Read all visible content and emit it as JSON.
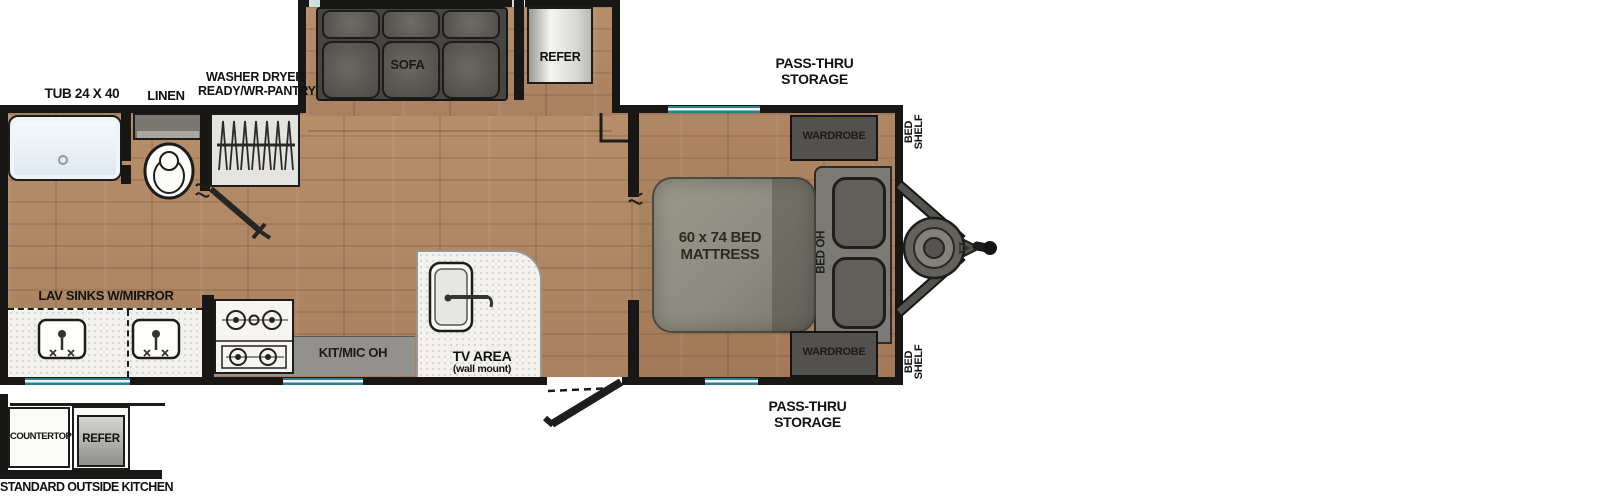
{
  "colors": {
    "floor_wood": "#b08a65",
    "wall_black": "#181715",
    "window_teal": "#2f7e8d",
    "counter_white": "#f2f1ed",
    "cushion_gray": "#5b5954",
    "mattress_gray": "#8e8b83",
    "label_black": "#121210"
  },
  "floorplan": {
    "bathroom": {
      "tub": "TUB 24 X 40",
      "linen": "LINEN",
      "pantry_line1": "WASHER DRYER",
      "pantry_line2": "READY/WR-PANTRY",
      "lav": "LAV SINKS W/MIRROR"
    },
    "living": {
      "sofa": "SOFA",
      "refer": "REFER",
      "kit_overhead": "KIT/MIC OH",
      "tv_line1": "TV AREA",
      "tv_line2": "(wall mount)"
    },
    "bedroom": {
      "mattress_line1": "60 x 74 BED",
      "mattress_line2": "MATTRESS",
      "bed_oh": "BED OH",
      "wardrobe": "WARDROBE",
      "bed_shelf_line1": "BED",
      "bed_shelf_line2": "SHELF"
    },
    "storage": {
      "pass_thru_line1": "PASS-THRU",
      "pass_thru_line2": "STORAGE"
    },
    "outside_kitchen": {
      "countertop": "COUNTERTOP",
      "refer": "REFER",
      "caption": "STANDARD OUTSIDE KITCHEN"
    }
  }
}
